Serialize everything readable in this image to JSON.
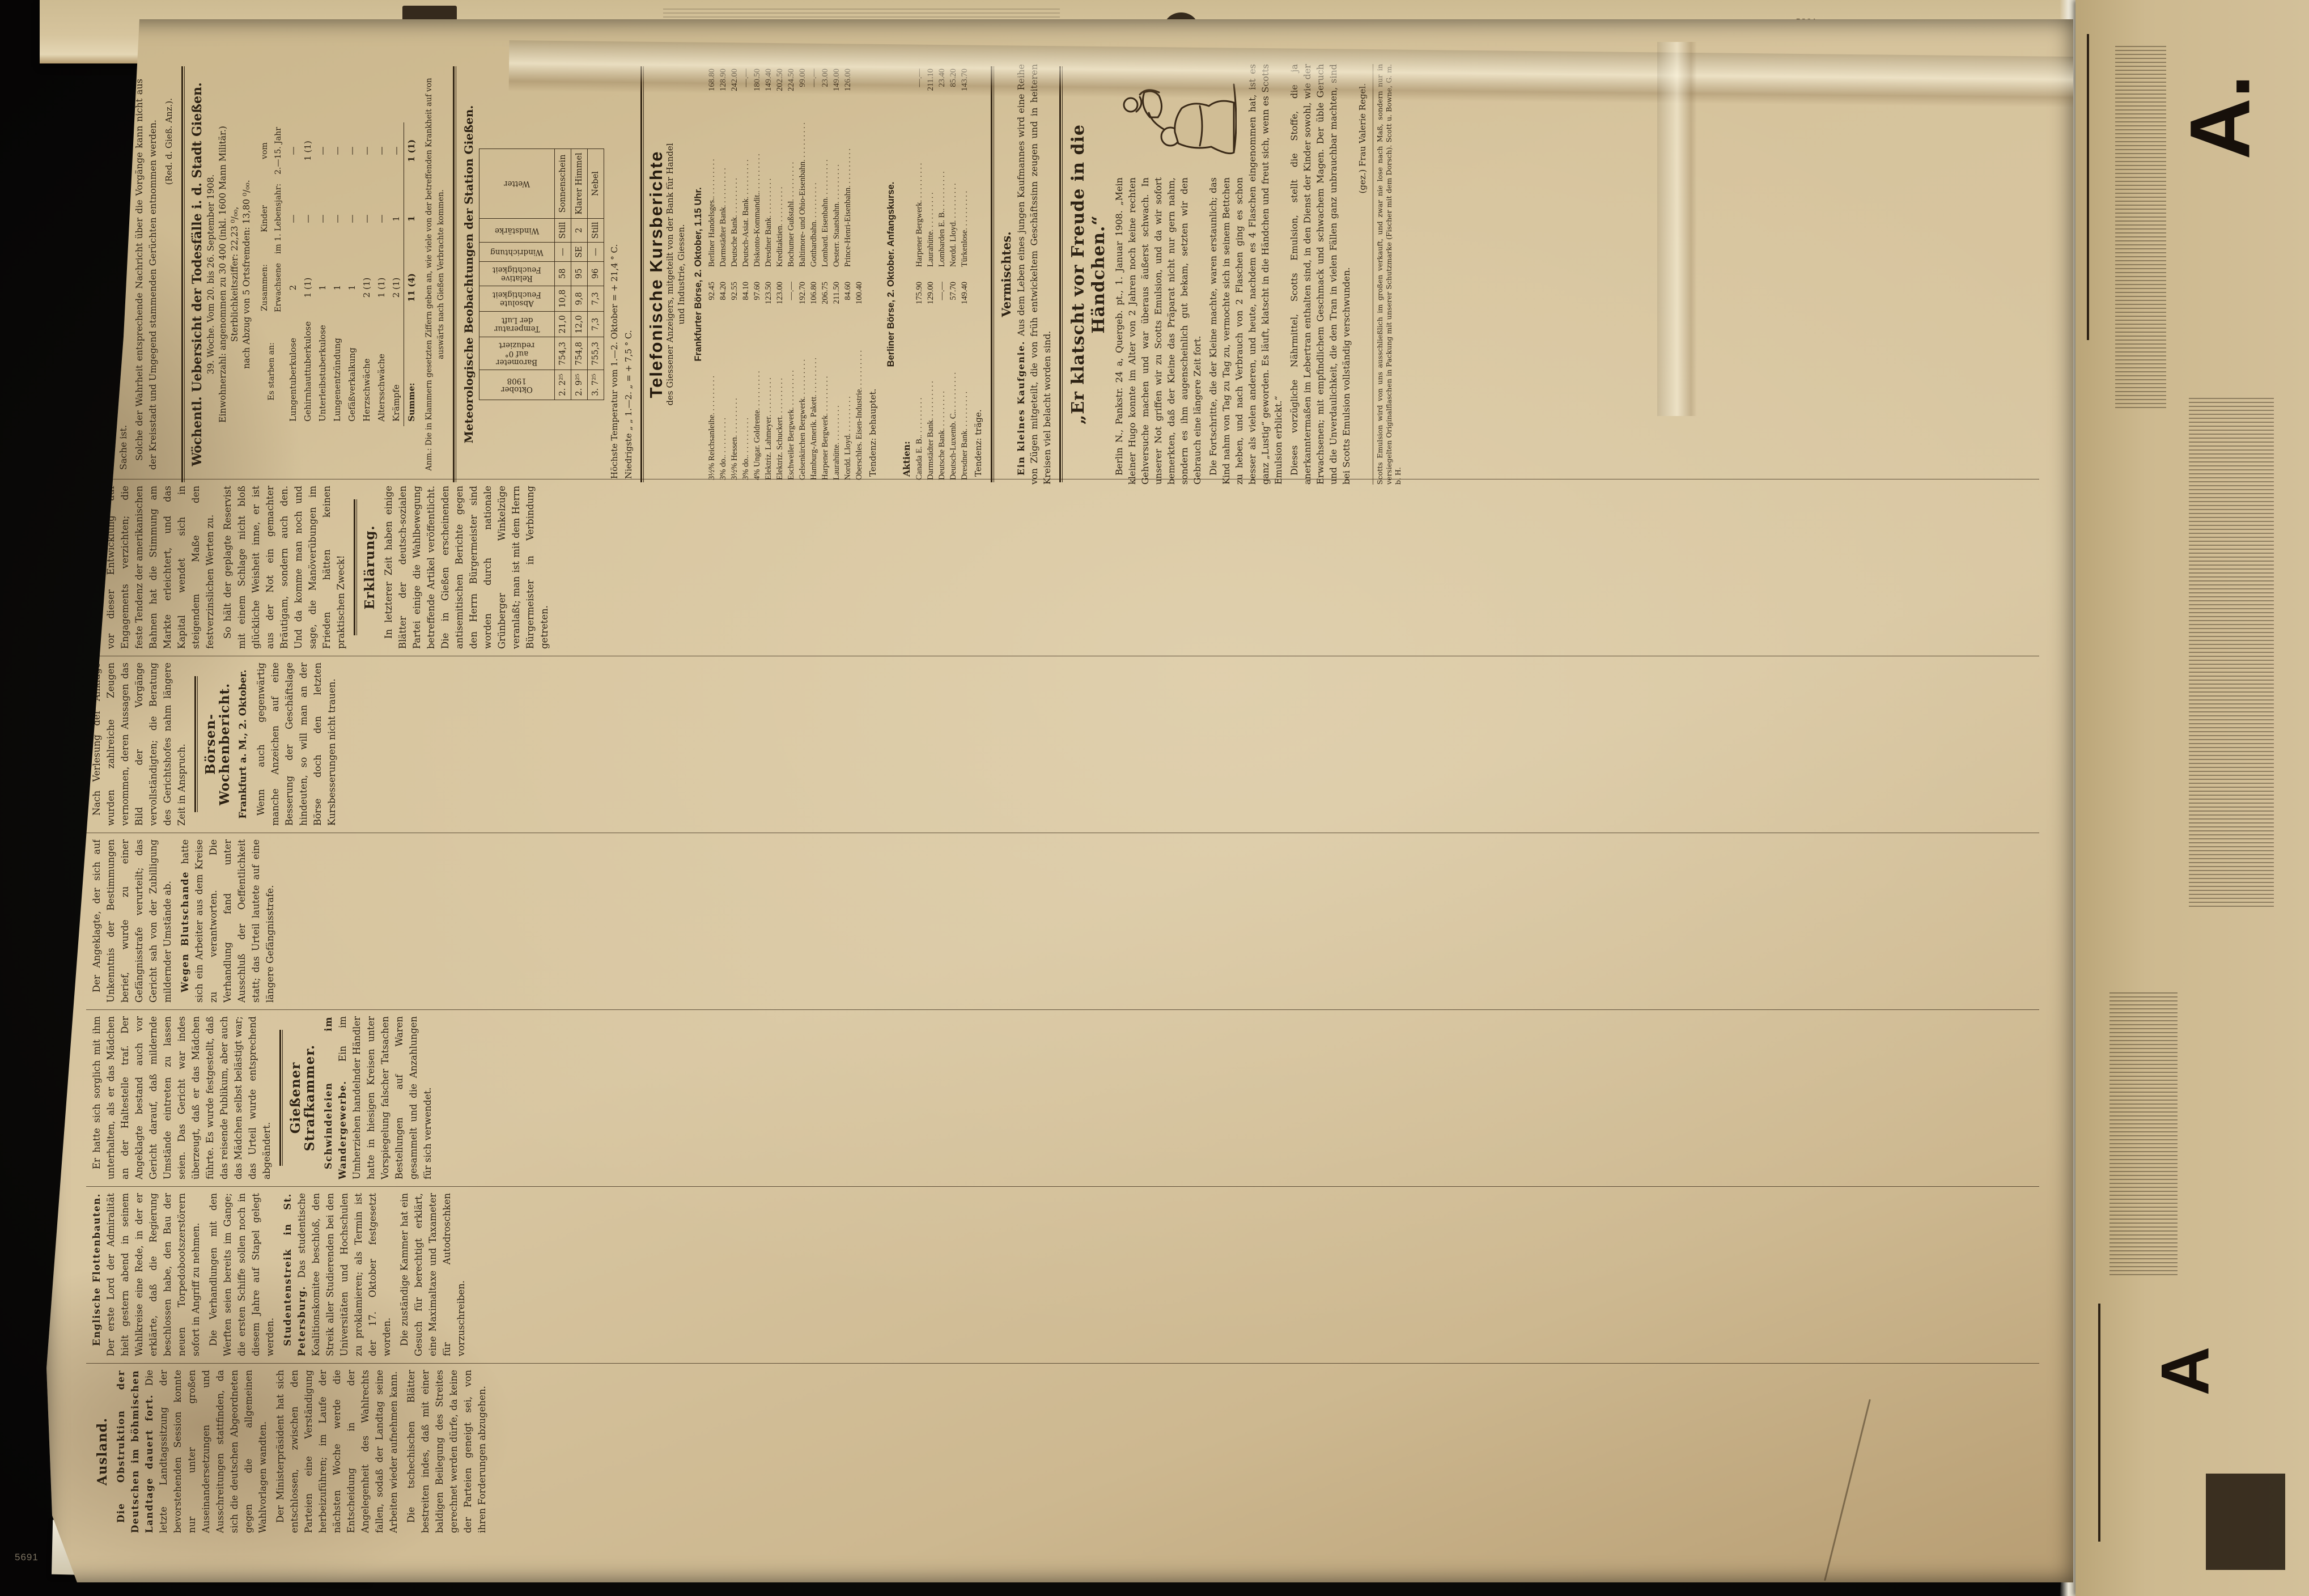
{
  "photo": {
    "archival_number": "5691",
    "adjacent_top_number": "5891",
    "top_strip_fragments": [
      "Un—",
      "Wa—",
      "S—",
      "Alle—",
      "Gi—",
      "Sch—",
      "wo—"
    ],
    "right_strip_big_letters": [
      "A.",
      "A"
    ]
  },
  "page": {
    "filler": [
      "Die Verhandlungen haben bis zur Stunde zu keinem greifbaren Ergebnis geführt, doch wird in unterrichteten Kreisen versichert, daß eine Einigung in den nächsten Tagen zu erwarten steht.",
      "Aus den beteiligten Kreisen wird hierzu noch gemeldet, daß die Vorbereitungen bereits seit längerer Zeit im Gange sind und mit einem Abschluß in Kürze gerechnet werden darf.",
      "Die Blätter besprechen den Vorgang in ausführlicher Weise und heben hervor, daß die Entscheidung von weittragender Bedeutung für die gesamte Lage sein dürfte.",
      "Wie verlautet, sollen die zuständigen Stellen noch in dieser Woche zusammentreten, um über die weiteren Schritte schlüssig zu werden.",
      "Der Angeklagte bestritt die ihm zur Last gelegten Handlungen; das Gericht erkannte jedoch auf Grund der Beweisaufnahme auf eine empfindliche Strafe.",
      "In den späten Abendstunden verbreitete sich die Nachricht, daß die Regierung eine Vorlage ausgearbeitet habe, die den gesamten Fragenkomplex regeln soll."
    ],
    "columns": [
      [
        {
          "type": "h",
          "text": "Ausland."
        },
        {
          "type": "lead",
          "lead": "Die Obstruktion der Deutschen im böhmischen Landtage dauert fort.",
          "text": "Die letzte Landtagssitzung der bevorstehenden Session konnte nur unter großen Auseinandersetzungen und Ausschreitungen stattfinden, da sich die deutschen Abgeordneten gegen die allgemeinen Wahlvorlagen wandten."
        },
        {
          "type": "p",
          "text": "Der Ministerpräsident hat sich entschlossen, zwischen den Parteien eine Verständigung herbeizuführen; im Laufe der nächsten Woche werde die Entscheidung in der Angelegenheit des Wahlrechts fallen, sodaß der Landtag seine Arbeiten wieder aufnehmen kann."
        },
        {
          "type": "p",
          "text": "Die tschechischen Blätter bestreiten indes, daß mit einer baldigen Beilegung des Streites gerechnet werden dürfe, da keine der Parteien geneigt sei, von ihren Forderungen abzugehen."
        }
      ],
      [
        {
          "type": "lead",
          "lead": "Englische Flottenbauten.",
          "text": "Der erste Lord der Admiralität hielt gestern abend in seinem Wahlkreise eine Rede, in der er erklärte, daß die Regierung beschlossen habe, den Bau der neuen Torpedobootszerstörern sofort in Angriff zu nehmen."
        },
        {
          "type": "p",
          "text": "Die Verhandlungen mit den Werften seien bereits im Gange; die ersten Schiffe sollen noch in diesem Jahre auf Stapel gelegt werden."
        },
        {
          "type": "lead",
          "lead": "Studentenstreik in St. Petersburg.",
          "text": "Das studentische Koalitionskomitee beschloß, den Streik aller Studierenden bei den Universitäten und Hochschulen zu proklamieren; als Termin ist der 17. Oktober festgesetzt worden."
        },
        {
          "type": "p",
          "text": "Die zuständige Kammer hat ein Gesuch für berechtigt erklärt, eine Maximaltaxe und Taxameter für Autodroschken vorzuschreiben."
        }
      ],
      [
        {
          "type": "p",
          "text": "Er hatte sich sorglich mit ihm unterhalten, als er das Mädchen an der Haltestelle traf. Der Angeklagte bestand auch vor Gericht darauf, daß mildernde Umstände eintreten zu lassen seien. Das Gericht war indes überzeugt, daß er das Mädchen führte. Es wurde festgestellt, daß das reisende Publikum, aber auch das Mädchen selbst belästigt war; das Urteil wurde entsprechend abgeändert."
        },
        {
          "type": "rule"
        },
        {
          "type": "h",
          "text": "Gießener Strafkammer."
        },
        {
          "type": "lead",
          "lead": "Schwindeleien im Wandergewerbe.",
          "text": "Ein im Umherziehen handelnder Händler hatte in hiesigen Kreisen unter Vorspiegelung falscher Tatsachen Bestellungen auf Waren gesammelt und die Anzahlungen für sich verwendet."
        }
      ],
      [
        {
          "type": "p",
          "text": "Der Angeklagte, der sich auf Unkenntnis der Bestimmungen berief, wurde zu einer Gefängnisstrafe verurteilt; das Gericht sah von der Zubilligung mildernder Umstände ab."
        },
        {
          "type": "lead",
          "lead": "Wegen Blutschande",
          "text": "hatte sich ein Arbeiter aus dem Kreise zu verantworten. Die Verhandlung fand unter Ausschluß der Oeffentlichkeit statt; das Urteil lautete auf eine längere Gefängnisstrafe."
        }
      ],
      [
        {
          "type": "p",
          "text": "Nach Verlesung der Anklage wurden zahlreiche Zeugen vernommen, deren Aussagen das Bild der Vorgänge vervollständigten; die Beratung des Gerichtshofes nahm längere Zeit in Anspruch."
        },
        {
          "type": "rule"
        },
        {
          "type": "h",
          "text": "Börsen-Wochenbericht."
        },
        {
          "type": "sub",
          "text": "Frankfurt a. M., 2. Oktober."
        },
        {
          "type": "p",
          "text": "Wenn auch gegenwärtig manche Anzeichen auf eine Besserung der Geschäftslage hindeuten, so will man an der Börse doch den letzten Kursbesserungen nicht trauen."
        }
      ],
      [
        {
          "type": "p",
          "text": "Die treibenden Kräfte müssen vor dieser Entwicklung auf Engagements verzichten; die feste Tendenz der amerikanischen Bahnen hat die Stimmung am Markte erleichtert, und das Kapital wendet sich in steigendem Maße den festverzinslichen Werten zu."
        },
        {
          "type": "p",
          "text": "So hält der geplagte Reservist mit einem Schlage nicht bloß glückliche Weisheit inne, er ist aus der Not ein gemachter Bräutigam, sondern auch den. Und da komme man noch und sage, die Manöverübungen im Frieden hätten keinen praktischen Zweck!"
        },
        {
          "type": "rule"
        },
        {
          "type": "h",
          "text": "Erklärung."
        },
        {
          "type": "p",
          "text": "In letzterer Zeit haben einige Blätter der deutsch-sozialen Partei einige die Wahlbewegung betreffende Artikel veröffentlicht. Die in Gießen erscheinenden antisemitischen Berichte gegen den Herrn Bürgermeister sind worden durch nationale Grünberger Winkelzüge veranlaßt; man ist mit dem Herrn Bürgermeister in Verbindung getreten."
        }
      ]
    ],
    "stack": {
      "erklaerung": {
        "paragraphs": [
          "Zu letzterer Zeit haben wir die Erklärung erhalten, daß die Aufrechterhaltung der Kandidatur Benner seitens des nationalen Wahlvereins für Grünberg beschlossene Sache ist.",
          "Solche der Wahrheit entsprechende Nachricht über die Vorgänge kann nicht aus der Kreisstadt und Umgegend stammenden Gerüchten entnommen werden."
        ],
        "signature": "(Red. d. Gieß. Anz.)."
      },
      "todesfaelle": {
        "heading": "Wöchentl. Uebersicht der Todesfälle i. d. Stadt Gießen.",
        "meta": [
          "39. Woche.  Vom 20. bis 26. September 1908.",
          "Einwohnerzahl: angenommen zu 30 400 (inkl. 1600 Mann Militär.)",
          "Sterblichkeitsziffer: 22,23 ⁰/₀₀,",
          "nach Abzug von 5 Ortsfremden: 13,80 ⁰/₀₀."
        ],
        "table": {
          "header": [
            "Es starben an:",
            "Zusammen:\nErwachsene",
            "Kinder\nim 1. Lebensjahr:",
            "vom\n2.—15. Jahr"
          ],
          "rows": [
            [
              "Lungentuberkulose",
              "2",
              "—",
              "—"
            ],
            [
              "Gehirnhauttuberkulose",
              "1 (1)",
              "—",
              "1 (1)"
            ],
            [
              "Unterleibstuberkulose",
              "1",
              "—",
              "—"
            ],
            [
              "Lungenentzündung",
              "1",
              "—",
              "—"
            ],
            [
              "Gefäßverkalkung",
              "1",
              "—",
              "—"
            ],
            [
              "Herzschwäche",
              "2 (1)",
              "—",
              "—"
            ],
            [
              "Altersschwäche",
              "1 (1)",
              "—",
              "—"
            ],
            [
              "Krämpfe",
              "2 (1)",
              "1",
              "—"
            ]
          ],
          "sum_row": [
            "Summe:",
            "11 (4)",
            "1",
            "1 (1)"
          ]
        },
        "footnote": "Anm.: Die in Klammern gesetzten Ziffern geben an, wie viele von der betreffenden Krankheit auf von auswärts nach Gießen Verbrachte kommen."
      },
      "meteo": {
        "heading": "Meteorologische Beobachtungen der Station Gießen.",
        "columns": [
          "Oktober\n1908",
          "Barometer\nauf 0°\nreduziert",
          "Temperatur\nder Luft",
          "Absolute\nFeuchtigkeit",
          "Relative\nFeuchtigkeit",
          "Windrichtung",
          "Windstärke",
          "Wetter"
        ],
        "rows": [
          [
            "2.  2²⁵",
            "754,3",
            "21,0",
            "10,8",
            "58",
            "—",
            "Still",
            "Sonnenschein"
          ],
          [
            "2.  9²⁵",
            "754,8",
            "12,0",
            "9,8",
            "95",
            "SE",
            "2",
            "Klarer Himmel"
          ],
          [
            "3.  7²⁵",
            "755,3",
            "7,3",
            "7,3",
            "96",
            "—",
            "Still",
            "Nebel"
          ]
        ],
        "summary": [
          "Höchste Temperatur vom 1.—2. Oktober = + 21,4 ° C.",
          "Niedrigste    „    „   1.—2.    „    = +  7,5 ° C."
        ]
      },
      "kurs": {
        "display_heading": "Telefonische Kursberichte",
        "subtitle": [
          "des Giessener Anzeigers, mitgeteilt von der Bank für Handel",
          "und Industrie, Giessen."
        ],
        "frankfurt_header": "Frankfurter Börse, 2. Oktober, 1.15 Uhr.",
        "frankfurt": [
          [
            "3½% Reichsanleihe",
            "92.45"
          ],
          [
            "3%  do.",
            "84.20"
          ],
          [
            "3½% Hessen",
            "92.55"
          ],
          [
            "3%  do.",
            "84.10"
          ],
          [
            "4% Ungar. Goldrente",
            "97.60"
          ],
          [
            "Elektriz. Lahmeyer",
            "123.50"
          ],
          [
            "Elektriz. Schuckert",
            "123.00"
          ],
          [
            "Eschweiler Bergwerk",
            "—.—"
          ],
          [
            "Gelsenkirchen Bergwerk",
            "192.70"
          ],
          [
            "Hamburg-Amerik. Pakett",
            "106.80"
          ],
          [
            "Harpener Bergwerk",
            "206.75"
          ],
          [
            "Laurahütte",
            "211.50"
          ],
          [
            "Nordd. Lloyd",
            "84.60"
          ],
          [
            "Oberschles. Eisen-Industrie",
            "100.40"
          ],
          [
            "Berliner Handelsges.",
            "168.80"
          ],
          [
            "Darmstädter Bank",
            "128.90"
          ],
          [
            "Deutsche Bank",
            "242.00"
          ],
          [
            "Deutsch-Asiat. Bank",
            "—.—"
          ],
          [
            "Diskonto-Kommandit.",
            "180.50"
          ],
          [
            "Dresdner Bank",
            "149.40"
          ],
          [
            "Kreditaktien",
            "202.50"
          ],
          [
            "Bochumer Gußstahl",
            "224.50"
          ],
          [
            "Baltimore- und Ohio-Eisenbahn",
            "99.00"
          ],
          [
            "Gotthardbahn",
            "—.—"
          ],
          [
            "Lombard. Eisenbahn",
            "23.00"
          ],
          [
            "Oesterr. Staatsbahn",
            "149.00"
          ],
          [
            "Prince-Henri-Eisenbahn",
            "126.00"
          ]
        ],
        "frankfurt_tendenz": "Tendenz: behauptet.",
        "berlin_header": "Berliner Börse, 2. Oktober.  Anfangskurse.",
        "aktien_label": "Aktien:",
        "berlin": [
          [
            "Canada E. B.",
            "175.90"
          ],
          [
            "Darmstädter Bank",
            "129.00"
          ],
          [
            "Deutsche Bank",
            "—.—"
          ],
          [
            "Deutsch-Luxemb. C.",
            "57.70"
          ],
          [
            "Dresdner Bank",
            "149.40"
          ],
          [
            "Harpener Bergwerk",
            "—.—"
          ],
          [
            "Laurahütte",
            "211.10"
          ],
          [
            "Lombarden E. B.",
            "23.40"
          ],
          [
            "Nordd. Lloyd",
            "85.20"
          ],
          [
            "Türkenlose",
            "143.70"
          ]
        ],
        "berlin_tendenz": "Tendenz: träge."
      },
      "vermischtes": {
        "heading": "Vermischtes.",
        "lead": "Ein kleines Kaufgenie.",
        "text": "Aus dem Leben eines jungen Kaufmannes wird eine Reihe von Zügen mitgeteilt, die von früh entwickeltem Geschäftssinn zeugen und in heiteren Kreisen viel belacht worden sind."
      },
      "ad": {
        "heading": "„Er klatscht vor Freude in die Händchen.“",
        "body": [
          "Berlin N., Pankstr. 24 a, Quergeb. pt., 1. Januar 1908. „Mein kleiner Hugo konnte im Alter von 2 Jahren noch keine rechten Gehversuche machen und war überaus äußerst schwach. In unserer Not griffen wir zu Scotts Emulsion, und da wir sofort bemerkten, daß der Kleine das Präparat nicht nur gern nahm, sondern es ihm augenscheinlich gut bekam, setzten wir den Gebrauch eine längere Zeit fort.",
          "Die Fortschritte, die der Kleine machte, waren erstaunlich; das Kind nahm von Tag zu Tag zu, vermochte sich in seinem Bettchen zu heben, und nach Verbrauch von 2 Flaschen ging es schon besser als vielen anderen, und heute, nachdem es 4 Flaschen eingenommen hat, ist es ganz „Lustig“ geworden. Es läuft, klatscht in die Händchen und freut sich, wenn es Scotts Emulsion erblickt.“",
          "Dieses vorzügliche Nährmittel, Scotts Emulsion, stellt die Stoffe, die ja anerkanntermaßen im Lebertran enthalten sind, in den Dienst der Kinder sowohl, wie der Erwachsenen; mit empfindlichem Geschmack und schwachem Magen. Der üble Geruch und die Unverdaulichkeit, die den Tran in vielen Fällen ganz unbrauchbar machten, sind bei Scotts Emulsion vollständig verschwunden."
        ],
        "signature": "(gez.) Frau Valerie Regel.",
        "smallprint": "Scotts Emulsion wird von uns ausschließlich im großen verkauft, und zwar nie lose nach Maß, sondern nur in versiegelten Originalflaschen in Packung mit unserer Schutzmarke (Fischer mit dem Dorsch). Scott u. Bowne, G. m. b. H."
      }
    }
  }
}
